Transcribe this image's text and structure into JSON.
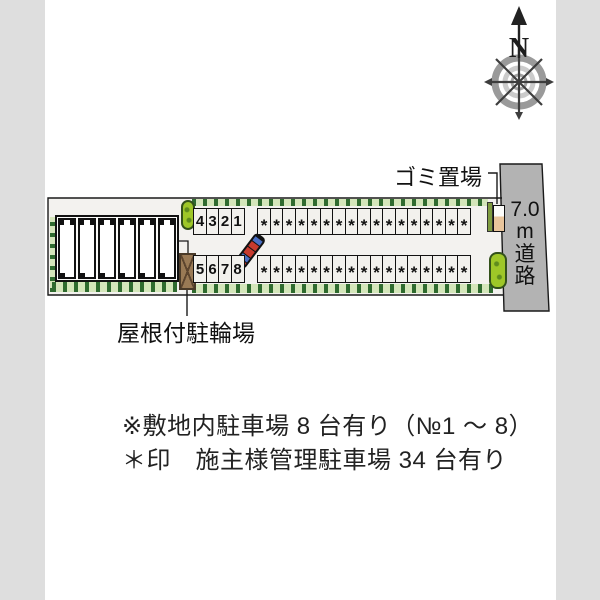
{
  "compass": {
    "north_label": "N"
  },
  "road": {
    "label_parts": [
      "7.0",
      "m",
      "道",
      "路"
    ],
    "fill": "#b3b3b3"
  },
  "labels": {
    "garbage_area": "ゴミ置場",
    "covered_bicycle_parking": "屋根付駐輪場"
  },
  "parking": {
    "top_row_numbers": [
      "4",
      "3",
      "2",
      "1"
    ],
    "bottom_row_numbers": [
      "5",
      "6",
      "7",
      "8"
    ],
    "managed_mark": "*",
    "managed_top_count": 17,
    "managed_bottom_count": 17,
    "numbered_total": 8,
    "managed_total": 34
  },
  "building": {
    "unit_count": 6
  },
  "notes": [
    "※敷地内駐車場 8 台有り（№1 ～ 8）",
    "＊印　施主様管理駐車場 34 台有り"
  ],
  "colors": {
    "side_margin": "#dedede",
    "road": "#b3b3b3",
    "hedge": "#d4e6ba",
    "bush": "#9ec728",
    "shed": "#9a7a55",
    "car_body": "#111111",
    "car_accent_red": "#c63a2e",
    "car_accent_blue": "#4a6fc4"
  }
}
